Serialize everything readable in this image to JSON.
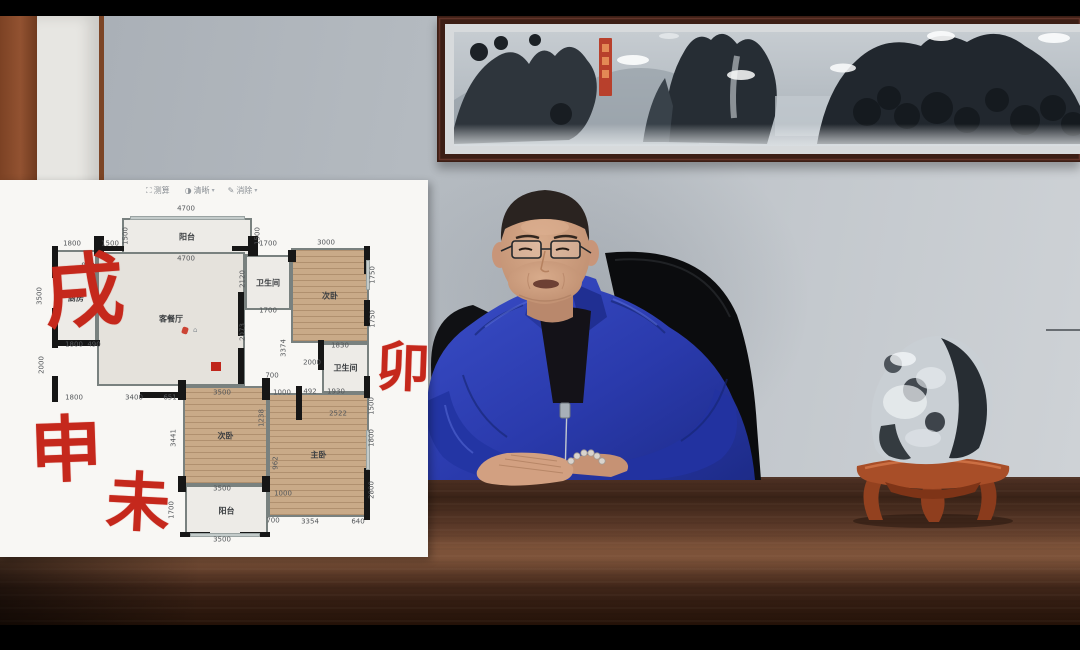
{
  "colors": {
    "annotation_red": "#c5281c",
    "jacket_blue": "#2e41b5",
    "panel_bg": "#f8f7f4",
    "wall_grey": "#b9bfc5",
    "desk_brown": "#4c2e1f"
  },
  "overlay_toolbar": {
    "items": [
      {
        "icon": "measure-icon",
        "glyph": "⛶",
        "label": "测算",
        "caret": ""
      },
      {
        "icon": "clarity-icon",
        "glyph": "◑",
        "label": "清晰",
        "caret": "▾"
      },
      {
        "icon": "eraser-icon",
        "glyph": "✎",
        "label": "消除",
        "caret": "▾"
      }
    ]
  },
  "floorplan": {
    "rooms": [
      {
        "name": "balcony-top",
        "label": "阳台",
        "x": 122,
        "y": 38,
        "w": 130,
        "h": 38,
        "floor": "tile"
      },
      {
        "name": "kitchen",
        "label": "厨房",
        "x": 55,
        "y": 70,
        "w": 42,
        "h": 95,
        "floor": "tile"
      },
      {
        "name": "living-dining",
        "label": "客餐厅",
        "x": 97,
        "y": 72,
        "w": 148,
        "h": 134,
        "floor": "grey"
      },
      {
        "name": "bath-1",
        "label": "卫生间",
        "x": 245,
        "y": 75,
        "w": 46,
        "h": 55,
        "floor": "tile"
      },
      {
        "name": "bedroom-2",
        "label": "次卧",
        "x": 291,
        "y": 68,
        "w": 78,
        "h": 95,
        "floor": "wood"
      },
      {
        "name": "bath-2",
        "label": "卫生间",
        "x": 322,
        "y": 163,
        "w": 47,
        "h": 50,
        "floor": "tile"
      },
      {
        "name": "walkin-closet",
        "label": "步入式衣柜",
        "x": 300,
        "y": 213,
        "w": 69,
        "h": 25,
        "floor": "tile"
      },
      {
        "name": "bedroom-3",
        "label": "次卧",
        "x": 183,
        "y": 206,
        "w": 85,
        "h": 99,
        "floor": "wood"
      },
      {
        "name": "master-bedroom",
        "label": "主卧",
        "x": 268,
        "y": 213,
        "w": 101,
        "h": 124,
        "floor": "wood"
      },
      {
        "name": "balcony-bottom",
        "label": "阳台",
        "x": 185,
        "y": 305,
        "w": 83,
        "h": 52,
        "floor": "tile"
      }
    ],
    "dimensions": [
      {
        "t": "4700",
        "x": 186,
        "y": 29
      },
      {
        "t": "1500",
        "x": 126,
        "y": 56,
        "v": 1
      },
      {
        "t": "1500",
        "x": 258,
        "y": 56,
        "v": 1
      },
      {
        "t": "4700",
        "x": 186,
        "y": 79
      },
      {
        "t": "1800",
        "x": 72,
        "y": 64
      },
      {
        "t": "1500",
        "x": 110,
        "y": 64
      },
      {
        "t": "1700",
        "x": 268,
        "y": 64
      },
      {
        "t": "3000",
        "x": 326,
        "y": 63
      },
      {
        "t": "938",
        "x": 88,
        "y": 86
      },
      {
        "t": "3500",
        "x": 40,
        "y": 116,
        "v": 1
      },
      {
        "t": "2120",
        "x": 243,
        "y": 99,
        "v": 1
      },
      {
        "t": "1700",
        "x": 268,
        "y": 131
      },
      {
        "t": "1750",
        "x": 373,
        "y": 95,
        "v": 1
      },
      {
        "t": "1750",
        "x": 373,
        "y": 139,
        "v": 1
      },
      {
        "t": "2073",
        "x": 243,
        "y": 152,
        "v": 1
      },
      {
        "t": "3374",
        "x": 284,
        "y": 168,
        "v": 1
      },
      {
        "t": "700",
        "x": 272,
        "y": 196
      },
      {
        "t": "1830",
        "x": 340,
        "y": 166
      },
      {
        "t": "2000",
        "x": 312,
        "y": 183
      },
      {
        "t": "2000",
        "x": 42,
        "y": 185,
        "v": 1
      },
      {
        "t": "1800",
        "x": 74,
        "y": 165
      },
      {
        "t": "490",
        "x": 94,
        "y": 165
      },
      {
        "t": "1800",
        "x": 74,
        "y": 218
      },
      {
        "t": "3400",
        "x": 134,
        "y": 218
      },
      {
        "t": "651",
        "x": 170,
        "y": 218
      },
      {
        "t": "3500",
        "x": 222,
        "y": 213
      },
      {
        "t": "1000",
        "x": 282,
        "y": 213
      },
      {
        "t": "492",
        "x": 310,
        "y": 212
      },
      {
        "t": "1930",
        "x": 336,
        "y": 212
      },
      {
        "t": "1500",
        "x": 372,
        "y": 226,
        "v": 1
      },
      {
        "t": "2522",
        "x": 338,
        "y": 234
      },
      {
        "t": "3441",
        "x": 174,
        "y": 258,
        "v": 1
      },
      {
        "t": "1238",
        "x": 262,
        "y": 238,
        "v": 1
      },
      {
        "t": "1800",
        "x": 372,
        "y": 258,
        "v": 1
      },
      {
        "t": "962",
        "x": 276,
        "y": 283,
        "v": 1
      },
      {
        "t": "2800",
        "x": 372,
        "y": 310,
        "v": 1
      },
      {
        "t": "3500",
        "x": 222,
        "y": 309
      },
      {
        "t": "1000",
        "x": 283,
        "y": 314
      },
      {
        "t": "1700",
        "x": 172,
        "y": 330,
        "v": 1
      },
      {
        "t": "700",
        "x": 273,
        "y": 341
      },
      {
        "t": "3354",
        "x": 310,
        "y": 342
      },
      {
        "t": "640",
        "x": 358,
        "y": 342
      },
      {
        "t": "3500",
        "x": 222,
        "y": 360
      }
    ],
    "annotations": [
      {
        "t": "戌",
        "x": 44,
        "y": 74,
        "s": 80,
        "r": -4
      },
      {
        "t": "卯",
        "x": 376,
        "y": 162,
        "s": 54,
        "r": 2
      },
      {
        "t": "申",
        "x": 30,
        "y": 236,
        "s": 72,
        "r": -2
      },
      {
        "t": "未",
        "x": 106,
        "y": 294,
        "s": 64,
        "r": 3
      }
    ],
    "house_glyph": "⌂"
  }
}
